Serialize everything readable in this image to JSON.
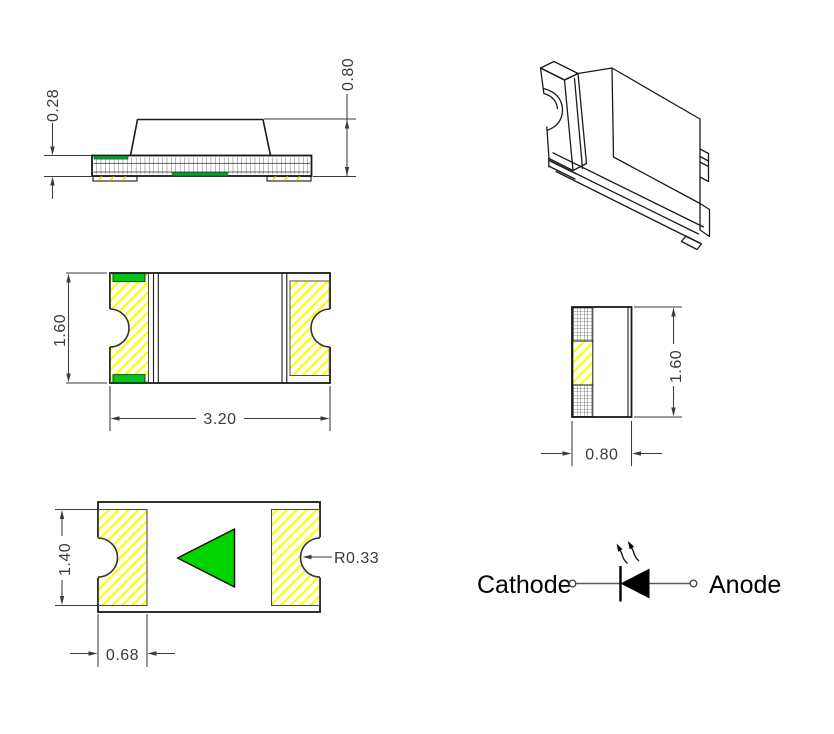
{
  "drawing": {
    "side_view": {
      "thickness": "0.28",
      "height": "0.80"
    },
    "top_view": {
      "height": "1.60",
      "width": "3.20"
    },
    "end_view": {
      "height": "1.60",
      "width": "0.80"
    },
    "bottom_view": {
      "pad_height": "1.40",
      "pad_offset": "0.68",
      "notch_radius": "R0.33"
    },
    "polarity": {
      "cathode": "Cathode",
      "anode": "Anode"
    }
  },
  "colors": {
    "outline": "#1a1a1a",
    "dimension": "#3b3b3b",
    "hatch_yellow": "#ffff00",
    "polarity_green": "#00d500",
    "substrate_green": "#009e2a"
  }
}
